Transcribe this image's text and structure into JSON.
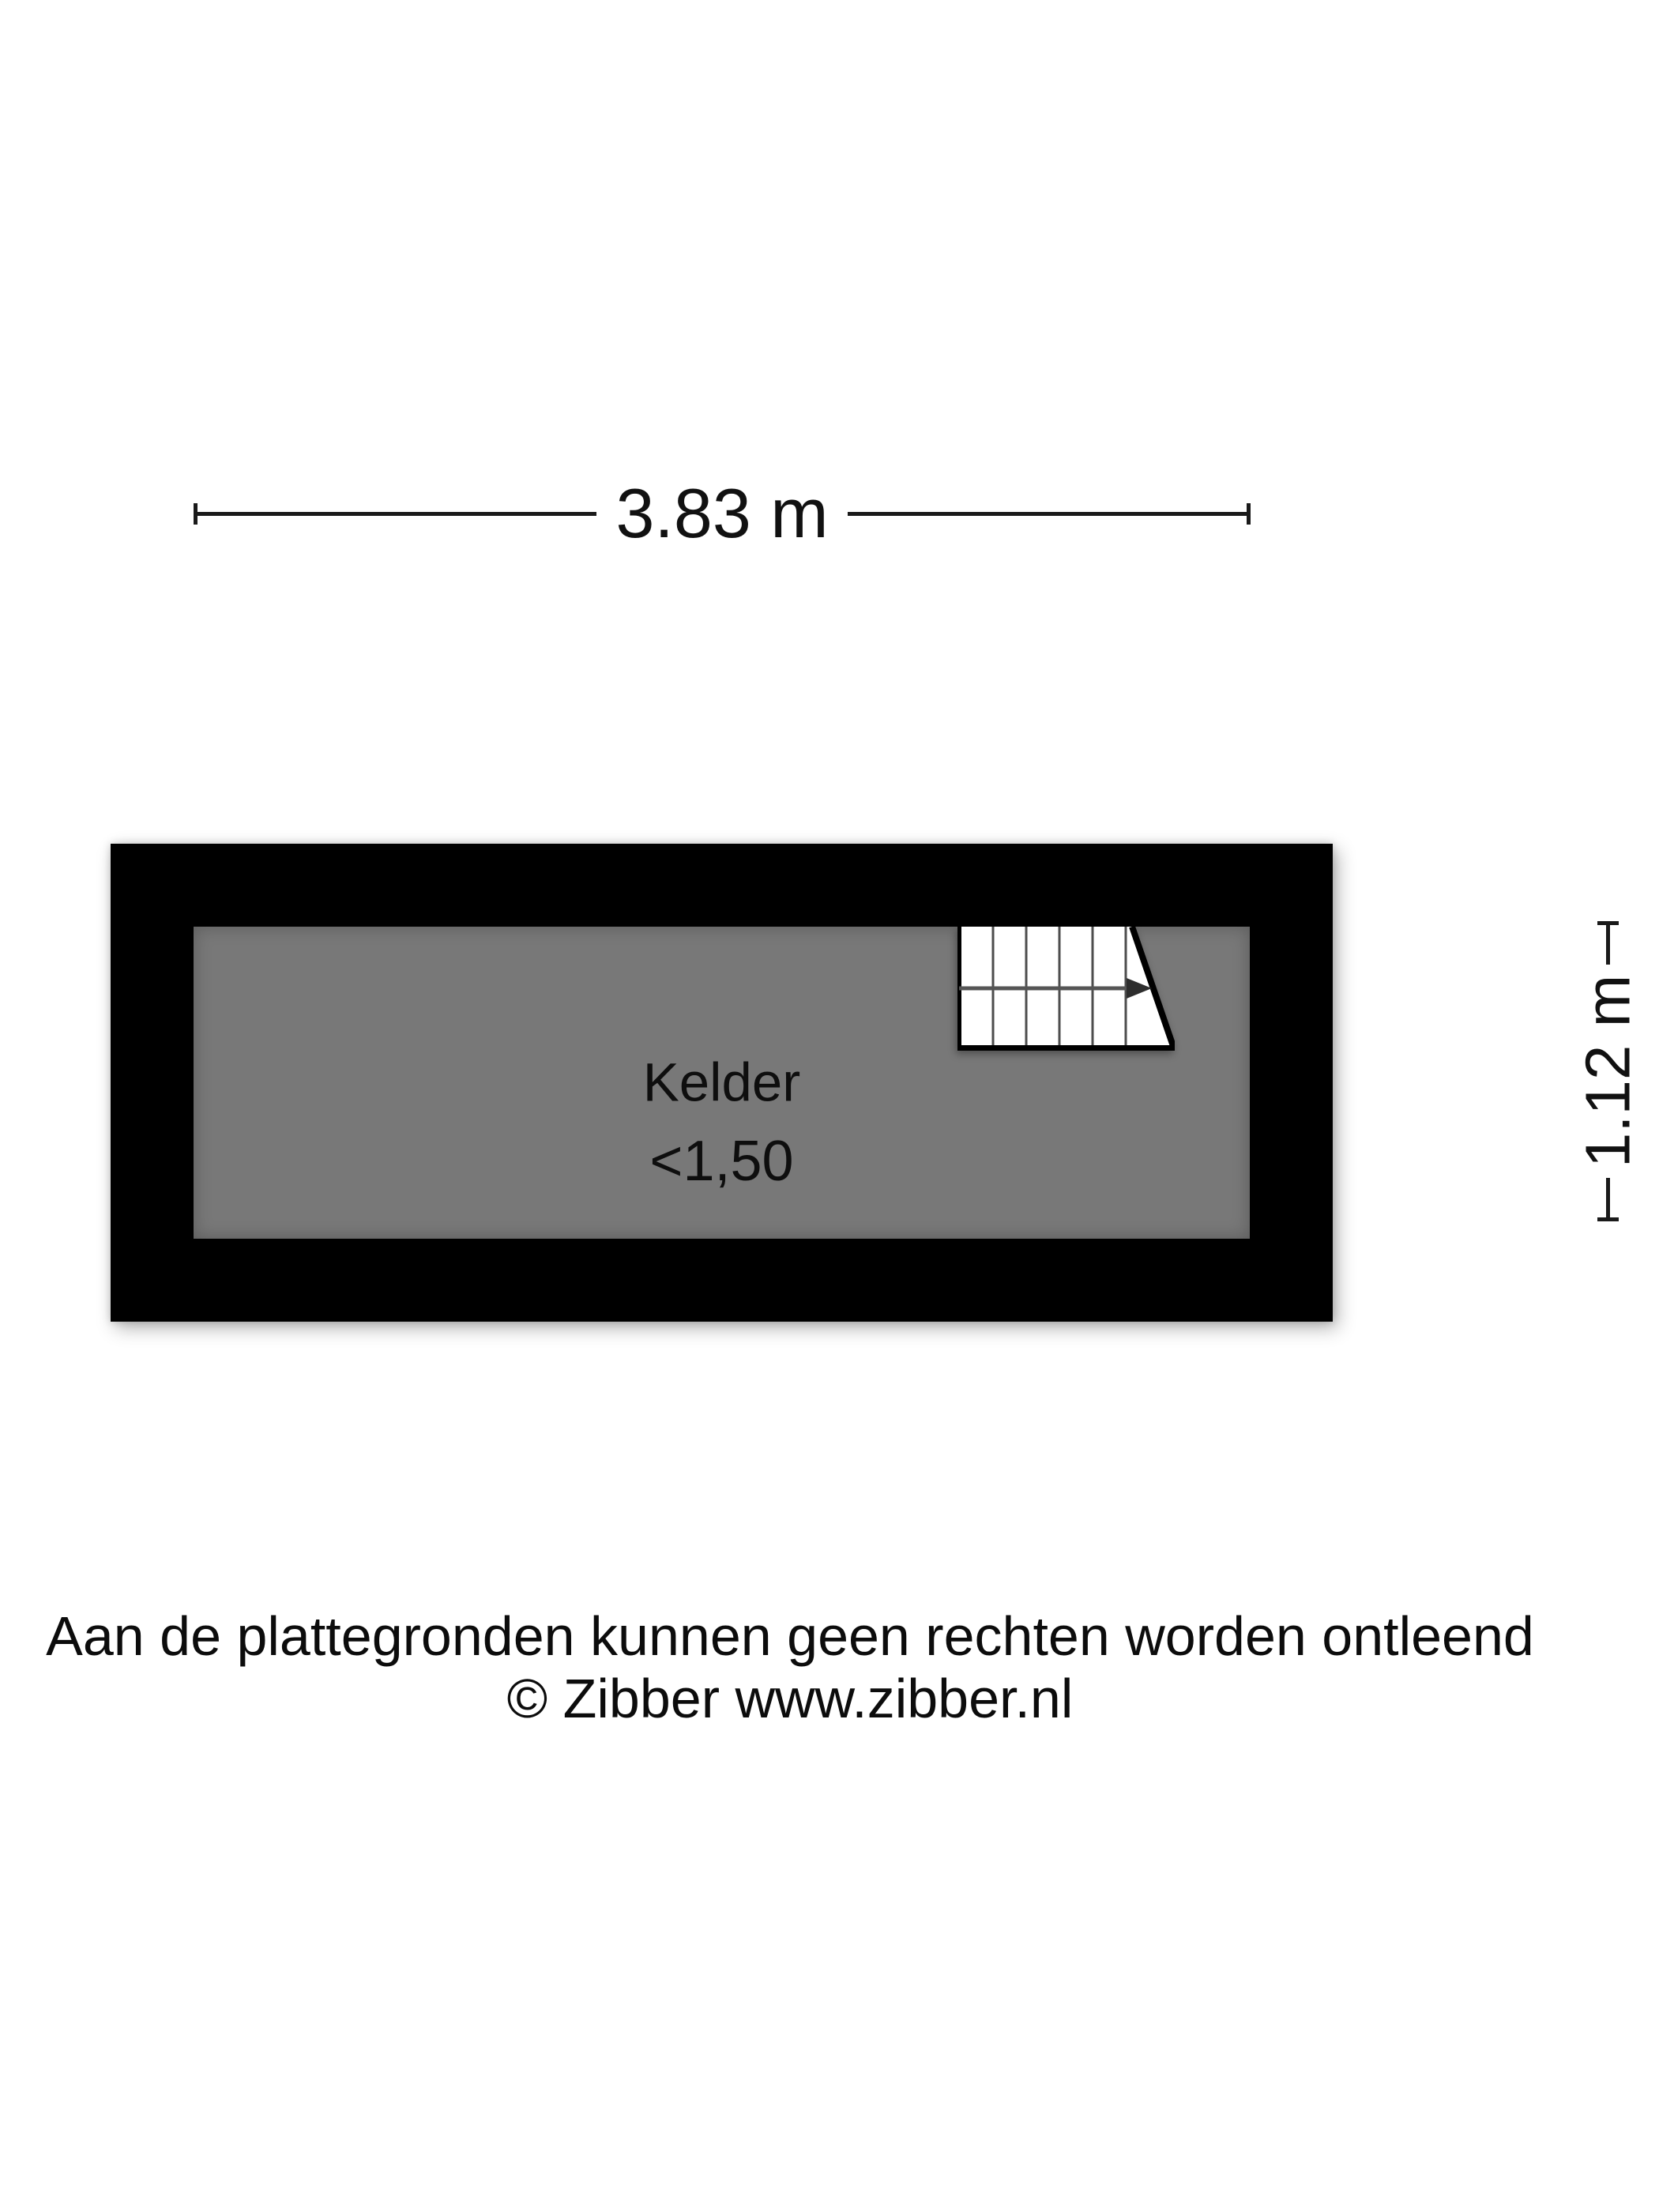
{
  "dimensions": {
    "width": {
      "label": "3.83 m"
    },
    "height": {
      "label": "1.12 m"
    }
  },
  "room": {
    "name": "Kelder",
    "height_note": "<1,50"
  },
  "stairs": {
    "tread_lines": 5,
    "direction": "right"
  },
  "footer": {
    "disclaimer": "Aan de plattegronden kunnen geen rechten worden ontleend",
    "copyright": "© Zibber www.zibber.nl"
  },
  "colors": {
    "wall": "#000000",
    "floor": "#787878",
    "stair_fill": "#ffffff",
    "line": "#1a1a1a",
    "background": "#ffffff"
  }
}
